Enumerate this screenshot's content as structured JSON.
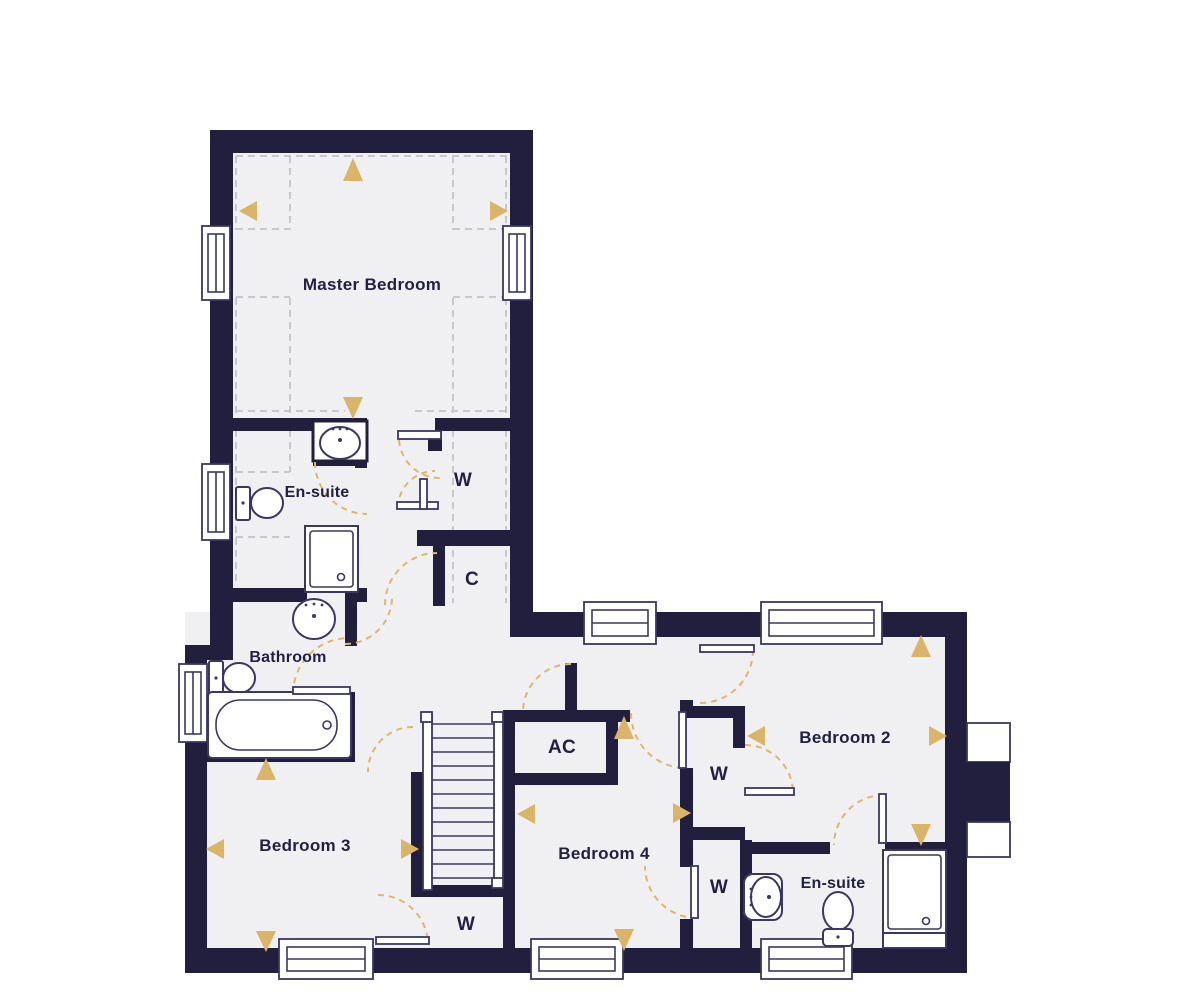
{
  "plan": {
    "type": "floor-plan",
    "rooms": {
      "master_bedroom": "Master Bedroom",
      "ensuite_top": "En-suite",
      "wardrobe_top": "W",
      "cupboard": "C",
      "bathroom": "Bathroom",
      "bedroom_3": "Bedroom 3",
      "wardrobe_under_stairs": "W",
      "airing_cupboard": "AC",
      "bedroom_4": "Bedroom 4",
      "wardrobe_mid_upper": "W",
      "wardrobe_mid_lower": "W",
      "bedroom_2": "Bedroom 2",
      "ensuite_bottom": "En-suite"
    },
    "colors": {
      "wall": "#221F3E",
      "floor": "#F0F0F2",
      "fixture_outline": "#3A3763",
      "door_arc": "#DDB76E",
      "arrow": "#D9B469",
      "ceiling_dash": "#C7C7CC",
      "label": "#232043",
      "background": "#FFFFFF"
    },
    "icons": {
      "arrow": "triangle",
      "door": "quarter-arc",
      "window": "triple-line-frame"
    }
  }
}
